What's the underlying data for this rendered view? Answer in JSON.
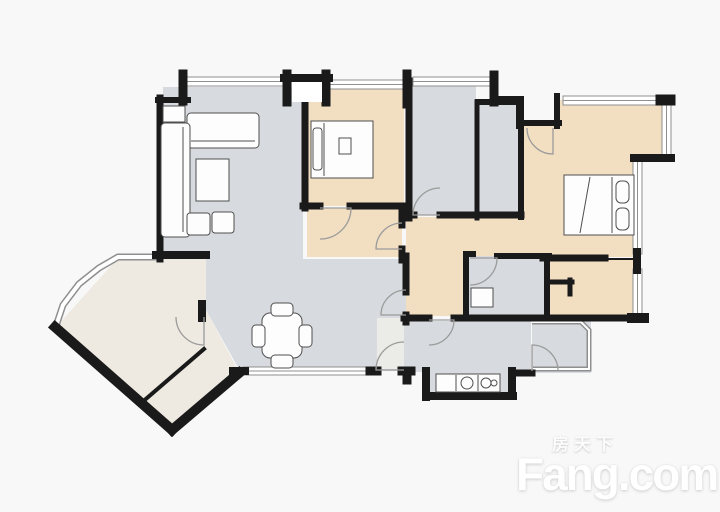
{
  "watermark": {
    "cn": "房天下",
    "en": "Fang.com"
  },
  "colors": {
    "background": "#f8f8f8",
    "wall": "#1a1a1a",
    "floor_gray": "#d7dade",
    "floor_tan": "#f2dfc1",
    "floor_cream": "#eeeae1",
    "floor_entry": "#ebebe8",
    "window_line": "#8f8f8f",
    "window_fill": "#ffffff",
    "door_line": "#9b9b9b",
    "furniture_stroke": "#4f4f4f",
    "furniture_fill": "#fdfdfd"
  },
  "floorplan": {
    "rooms": [
      {
        "name": "living-dining-room",
        "fill": "floor_gray",
        "points": [
          [
            163,
            87
          ],
          [
            303,
            87
          ],
          [
            303,
            259
          ],
          [
            406,
            259
          ],
          [
            406,
            371
          ],
          [
            240,
            371
          ],
          [
            206,
            310
          ],
          [
            206,
            258
          ],
          [
            163,
            258
          ]
        ]
      },
      {
        "name": "entry-strip",
        "fill": "floor_entry",
        "points": [
          [
            377,
            318
          ],
          [
            404,
            318
          ],
          [
            404,
            369
          ],
          [
            377,
            369
          ]
        ]
      },
      {
        "name": "balcony",
        "fill": "floor_cream",
        "points": [
          [
            56,
            327
          ],
          [
            118,
            258
          ],
          [
            206,
            258
          ],
          [
            206,
            310
          ],
          [
            239,
            372
          ],
          [
            172,
            430
          ]
        ]
      },
      {
        "name": "hallway",
        "fill": "floor_tan",
        "points": [
          [
            406,
            217
          ],
          [
            545,
            217
          ],
          [
            545,
            316
          ],
          [
            406,
            316
          ]
        ]
      },
      {
        "name": "vestibule",
        "fill": "floor_tan",
        "points": [
          [
            307,
            208
          ],
          [
            402,
            208
          ],
          [
            402,
            257
          ],
          [
            307,
            257
          ]
        ]
      },
      {
        "name": "bedroom-2",
        "fill": "floor_tan",
        "points": [
          [
            307,
            88
          ],
          [
            404,
            88
          ],
          [
            404,
            206
          ],
          [
            307,
            206
          ]
        ]
      },
      {
        "name": "bathroom-1",
        "fill": "floor_gray",
        "points": [
          [
            411,
            84
          ],
          [
            476,
            84
          ],
          [
            476,
            215
          ],
          [
            411,
            215
          ]
        ]
      },
      {
        "name": "duct-room",
        "fill": "floor_gray",
        "points": [
          [
            479,
            104
          ],
          [
            519,
            104
          ],
          [
            519,
            215
          ],
          [
            479,
            215
          ]
        ]
      },
      {
        "name": "master-bedroom",
        "fill": "floor_tan",
        "points": [
          [
            522,
            126
          ],
          [
            557,
            126
          ],
          [
            557,
            100
          ],
          [
            663,
            100
          ],
          [
            663,
            158
          ],
          [
            636,
            158
          ],
          [
            636,
            257
          ],
          [
            545,
            257
          ],
          [
            545,
            218
          ],
          [
            522,
            218
          ]
        ]
      },
      {
        "name": "bathroom-2",
        "fill": "floor_gray",
        "points": [
          [
            468,
            256
          ],
          [
            547,
            256
          ],
          [
            547,
            317
          ],
          [
            468,
            317
          ]
        ]
      },
      {
        "name": "bedroom-3",
        "fill": "floor_tan",
        "points": [
          [
            546,
            259
          ],
          [
            636,
            259
          ],
          [
            636,
            318
          ],
          [
            546,
            318
          ]
        ]
      },
      {
        "name": "kitchen",
        "fill": "floor_gray",
        "points": [
          [
            406,
            321
          ],
          [
            531,
            321
          ],
          [
            531,
            372
          ],
          [
            513,
            372
          ],
          [
            513,
            395
          ],
          [
            427,
            395
          ],
          [
            427,
            372
          ],
          [
            406,
            372
          ]
        ]
      },
      {
        "name": "service-balcony",
        "fill": "floor_gray",
        "points": [
          [
            532,
            321
          ],
          [
            591,
            321
          ],
          [
            591,
            373
          ],
          [
            532,
            373
          ]
        ]
      }
    ],
    "windows": [
      {
        "name": "living-room-window",
        "x": 186,
        "y": 77,
        "w": 97,
        "h": 9
      },
      {
        "name": "bedroom-2-window",
        "x": 330,
        "y": 80,
        "w": 74,
        "h": 9
      },
      {
        "name": "bathroom-1-window",
        "x": 413,
        "y": 77,
        "w": 79,
        "h": 9
      },
      {
        "name": "master-bedroom-window-top",
        "x": 563,
        "y": 96,
        "w": 100,
        "h": 9
      },
      {
        "name": "master-bedroom-window-right",
        "x": 662,
        "y": 104,
        "w": 9,
        "h": 54
      },
      {
        "name": "master-bedroom-window-lower",
        "x": 633,
        "y": 161,
        "w": 9,
        "h": 93
      },
      {
        "name": "bedroom-3-window",
        "x": 633,
        "y": 269,
        "w": 9,
        "h": 49
      },
      {
        "name": "dining-window",
        "x": 243,
        "y": 367,
        "w": 128,
        "h": 8
      },
      {
        "name": "balcony-curved-window",
        "band": [
          [
            56,
            326
          ],
          [
            63,
            305
          ],
          [
            79,
            284
          ],
          [
            99,
            268
          ],
          [
            118,
            257
          ],
          [
            157,
            257
          ]
        ],
        "bw": 7
      },
      {
        "name": "service-balcony-railing",
        "band": [
          [
            532,
            322
          ],
          [
            581,
            322
          ],
          [
            589,
            330
          ],
          [
            589,
            369
          ],
          [
            533,
            369
          ]
        ],
        "bw": 5
      }
    ],
    "walls": [
      [
        160,
        98,
        160,
        259,
        7
      ],
      [
        158,
        100,
        188,
        100,
        6
      ],
      [
        183,
        74,
        183,
        101,
        9
      ],
      [
        287,
        74,
        287,
        102,
        9
      ],
      [
        326,
        74,
        326,
        102,
        9
      ],
      [
        284,
        78,
        329,
        78,
        8
      ],
      [
        407,
        74,
        407,
        104,
        9
      ],
      [
        494,
        75,
        494,
        102,
        9
      ],
      [
        493,
        99,
        521,
        99,
        6
      ],
      [
        519,
        99,
        519,
        126,
        6
      ],
      [
        519,
        123,
        559,
        123,
        6
      ],
      [
        557,
        96,
        557,
        126,
        6
      ],
      [
        661,
        100,
        670,
        100,
        11
      ],
      [
        634,
        158,
        671,
        158,
        8
      ],
      [
        637,
        252,
        637,
        270,
        8
      ],
      [
        156,
        255,
        206,
        255,
        8
      ],
      [
        55,
        327,
        172,
        430,
        10
      ],
      [
        172,
        430,
        239,
        373,
        10
      ],
      [
        140,
        404,
        204,
        349,
        4
      ],
      [
        202,
        304,
        202,
        318,
        8
      ],
      [
        233,
        371,
        245,
        371,
        8
      ],
      [
        305,
        100,
        305,
        208,
        7
      ],
      [
        303,
        206,
        320,
        206,
        7
      ],
      [
        350,
        206,
        406,
        206,
        7
      ],
      [
        402,
        206,
        402,
        225,
        7
      ],
      [
        402,
        249,
        402,
        260,
        7
      ],
      [
        409,
        81,
        409,
        218,
        7
      ],
      [
        477,
        102,
        477,
        218,
        5
      ],
      [
        478,
        102,
        521,
        102,
        6
      ],
      [
        521,
        102,
        521,
        217,
        6
      ],
      [
        409,
        215,
        414,
        215,
        7
      ],
      [
        440,
        215,
        521,
        215,
        7
      ],
      [
        497,
        256,
        549,
        256,
        6
      ],
      [
        466,
        254,
        466,
        318,
        6
      ],
      [
        547,
        256,
        547,
        318,
        6
      ],
      [
        466,
        254,
        473,
        254,
        6
      ],
      [
        543,
        258,
        605,
        258,
        7
      ],
      [
        604,
        259,
        637,
        259,
        2
      ],
      [
        406,
        256,
        406,
        292,
        7
      ],
      [
        406,
        315,
        406,
        322,
        7
      ],
      [
        404,
        318,
        429,
        318,
        7
      ],
      [
        454,
        318,
        642,
        318,
        7
      ],
      [
        632,
        318,
        644,
        318,
        10
      ],
      [
        370,
        371,
        377,
        371,
        9
      ],
      [
        402,
        371,
        411,
        371,
        9
      ],
      [
        407,
        371,
        407,
        380,
        9
      ],
      [
        426,
        371,
        426,
        397,
        8
      ],
      [
        426,
        396,
        513,
        396,
        8
      ],
      [
        512,
        396,
        512,
        371,
        8
      ],
      [
        512,
        373,
        532,
        373,
        7
      ],
      [
        548,
        282,
        572,
        282,
        5
      ],
      [
        570,
        280,
        570,
        294,
        5
      ]
    ],
    "doors": [
      {
        "name": "bedroom-2-door",
        "cx": 320,
        "cy": 208,
        "r": 31,
        "a1": 0,
        "a2": 90
      },
      {
        "name": "vestibule-door",
        "cx": 402,
        "cy": 249,
        "r": 26,
        "a1": 180,
        "a2": 270
      },
      {
        "name": "bathroom-1-door",
        "cx": 440,
        "cy": 215,
        "r": 27,
        "a1": 180,
        "a2": 270
      },
      {
        "name": "master-bedroom-door",
        "cx": 553,
        "cy": 128,
        "r": 26,
        "a1": 90,
        "a2": 180
      },
      {
        "name": "bathroom-2-door",
        "cx": 470,
        "cy": 258,
        "r": 27,
        "a1": 0,
        "a2": 90
      },
      {
        "name": "kitchen-door",
        "cx": 429,
        "cy": 320,
        "r": 25,
        "a1": 0,
        "a2": 90
      },
      {
        "name": "hall-door",
        "cx": 406,
        "cy": 315,
        "r": 25,
        "a1": 180,
        "a2": 270
      },
      {
        "name": "entry-door",
        "cx": 404,
        "cy": 370,
        "r": 28,
        "a1": 180,
        "a2": 270
      },
      {
        "name": "balcony-door",
        "cx": 204,
        "cy": 317,
        "r": 28,
        "a1": 90,
        "a2": 180
      },
      {
        "name": "service-balcony-door",
        "cx": 532,
        "cy": 371,
        "r": 26,
        "a1": 270,
        "a2": 360
      }
    ],
    "furniture": [
      {
        "name": "pier-infill",
        "type": "rect",
        "x": 292,
        "y": 82,
        "w": 30,
        "h": 20,
        "fill": "#ffffff",
        "stroke": "none"
      },
      {
        "name": "sofa-main",
        "type": "rect",
        "x": 187,
        "y": 113,
        "w": 72,
        "h": 35,
        "r": 4
      },
      {
        "name": "sofa-main-seatline",
        "type": "line",
        "x1": 191,
        "y1": 141,
        "x2": 255,
        "y2": 141
      },
      {
        "name": "sofa-chaise",
        "type": "rect",
        "x": 161,
        "y": 123,
        "w": 29,
        "h": 114,
        "r": 4
      },
      {
        "name": "sofa-chaise-seatline",
        "type": "line",
        "x1": 183,
        "y1": 127,
        "x2": 183,
        "y2": 232
      },
      {
        "name": "side-table",
        "type": "rect",
        "x": 163,
        "y": 106,
        "w": 22,
        "h": 16
      },
      {
        "name": "coffee-table",
        "type": "rect",
        "x": 196,
        "y": 159,
        "w": 33,
        "h": 42
      },
      {
        "name": "stool-1",
        "type": "rect",
        "x": 187,
        "y": 213,
        "w": 23,
        "h": 22,
        "r": 3
      },
      {
        "name": "stool-2",
        "type": "rect",
        "x": 212,
        "y": 212,
        "w": 22,
        "h": 21,
        "r": 3
      },
      {
        "name": "bed-2",
        "type": "rect",
        "x": 311,
        "y": 121,
        "w": 62,
        "h": 57
      },
      {
        "name": "bed-2-headboard",
        "type": "line",
        "x1": 324,
        "y1": 123,
        "x2": 324,
        "y2": 176
      },
      {
        "name": "bed-2-pillow",
        "type": "rect",
        "x": 313,
        "y": 128,
        "w": 9,
        "h": 42,
        "r": 3
      },
      {
        "name": "bed-2-item",
        "type": "rect",
        "x": 339,
        "y": 138,
        "w": 12,
        "h": 16
      },
      {
        "name": "master-bed",
        "type": "rect",
        "x": 564,
        "y": 175,
        "w": 70,
        "h": 60
      },
      {
        "name": "master-bed-pillowline",
        "type": "line",
        "x1": 612,
        "y1": 177,
        "x2": 612,
        "y2": 233
      },
      {
        "name": "master-bed-pillow-1",
        "type": "rect",
        "x": 616,
        "y": 181,
        "w": 13,
        "h": 22,
        "r": 5
      },
      {
        "name": "master-bed-pillow-2",
        "type": "rect",
        "x": 616,
        "y": 208,
        "w": 13,
        "h": 22,
        "r": 5
      },
      {
        "name": "master-bed-fold",
        "type": "line",
        "x1": 590,
        "y1": 177,
        "x2": 580,
        "y2": 233
      },
      {
        "name": "dining-table",
        "type": "rect",
        "x": 262,
        "y": 313,
        "w": 40,
        "h": 45,
        "r": 8
      },
      {
        "name": "dining-chair-top",
        "type": "rect",
        "x": 271,
        "y": 303,
        "w": 22,
        "h": 13,
        "r": 4
      },
      {
        "name": "dining-chair-bottom",
        "type": "rect",
        "x": 271,
        "y": 355,
        "w": 22,
        "h": 13,
        "r": 4
      },
      {
        "name": "dining-chair-left",
        "type": "rect",
        "x": 252,
        "y": 325,
        "w": 13,
        "h": 22,
        "r": 4
      },
      {
        "name": "dining-chair-right",
        "type": "rect",
        "x": 299,
        "y": 325,
        "w": 13,
        "h": 22,
        "r": 4
      },
      {
        "name": "kitchen-counter",
        "type": "rect",
        "x": 436,
        "y": 374,
        "w": 64,
        "h": 18
      },
      {
        "name": "counter-divider-1",
        "type": "line",
        "x1": 456,
        "y1": 375,
        "x2": 456,
        "y2": 391
      },
      {
        "name": "counter-divider-2",
        "type": "line",
        "x1": 478,
        "y1": 375,
        "x2": 478,
        "y2": 391
      },
      {
        "name": "sink",
        "type": "circle",
        "cx": 467,
        "cy": 383,
        "r": 6
      },
      {
        "name": "stove-burner-1",
        "type": "circle",
        "cx": 486,
        "cy": 383,
        "r": 5
      },
      {
        "name": "stove-burner-2",
        "type": "circle",
        "cx": 494,
        "cy": 383,
        "r": 3
      },
      {
        "name": "washing-machine",
        "type": "rect",
        "x": 471,
        "y": 288,
        "w": 22,
        "h": 19
      }
    ]
  }
}
